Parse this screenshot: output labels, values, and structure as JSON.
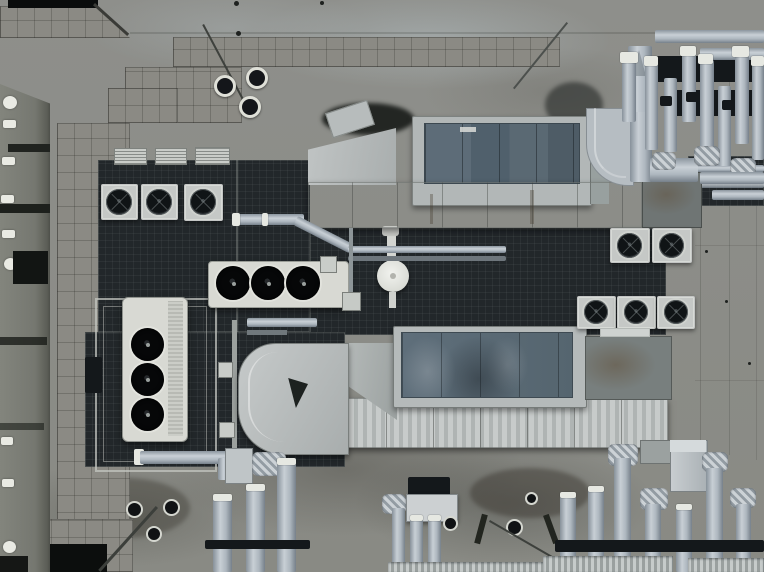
{
  "scene": {
    "title": "Aerial top-down photograph of a building rooftop crowded with HVAC equipment",
    "description": "Drone view straight down onto a concrete roof: two large air-handling units with blue-grey panels and long galvanized ducts run diagonally across the roof, surrounded by condenser fan units, louvered vents, insulated pipe clusters with flex elbows, paver walkways, roof drains and a parapet wall with small white vents on the left.",
    "objects": [
      "paver-walkways",
      "parapet-wall-with-vents",
      "roof-drains",
      "upper-air-handler",
      "lower-air-handler",
      "main-supply-ducts",
      "horizontal-condenser-3-fans",
      "vertical-condenser-3-fans",
      "small-fan-units-row",
      "louver-vents",
      "mushroom-roof-vent",
      "right-fan-unit-rows",
      "insulated-pipe-cluster-top-right",
      "insulated-pipe-cluster-bottom-right",
      "pipe-manifold-bottom",
      "equipment-mesh-platforms",
      "concrete-slab"
    ]
  },
  "palette": {
    "concrete": "#8e8f8b",
    "paver": "#8b8a84",
    "platform": "#22272a",
    "ductlight": "#b5babb",
    "panelblue": "#5a6a76",
    "pipesteel": "#b4bdc5",
    "fanblack": "#0b0d0f",
    "unitwhite": "#d8d9d3",
    "wall": "#7b7d75",
    "ventwhite": "#e9eae3",
    "rust": "#6b5f4c"
  }
}
